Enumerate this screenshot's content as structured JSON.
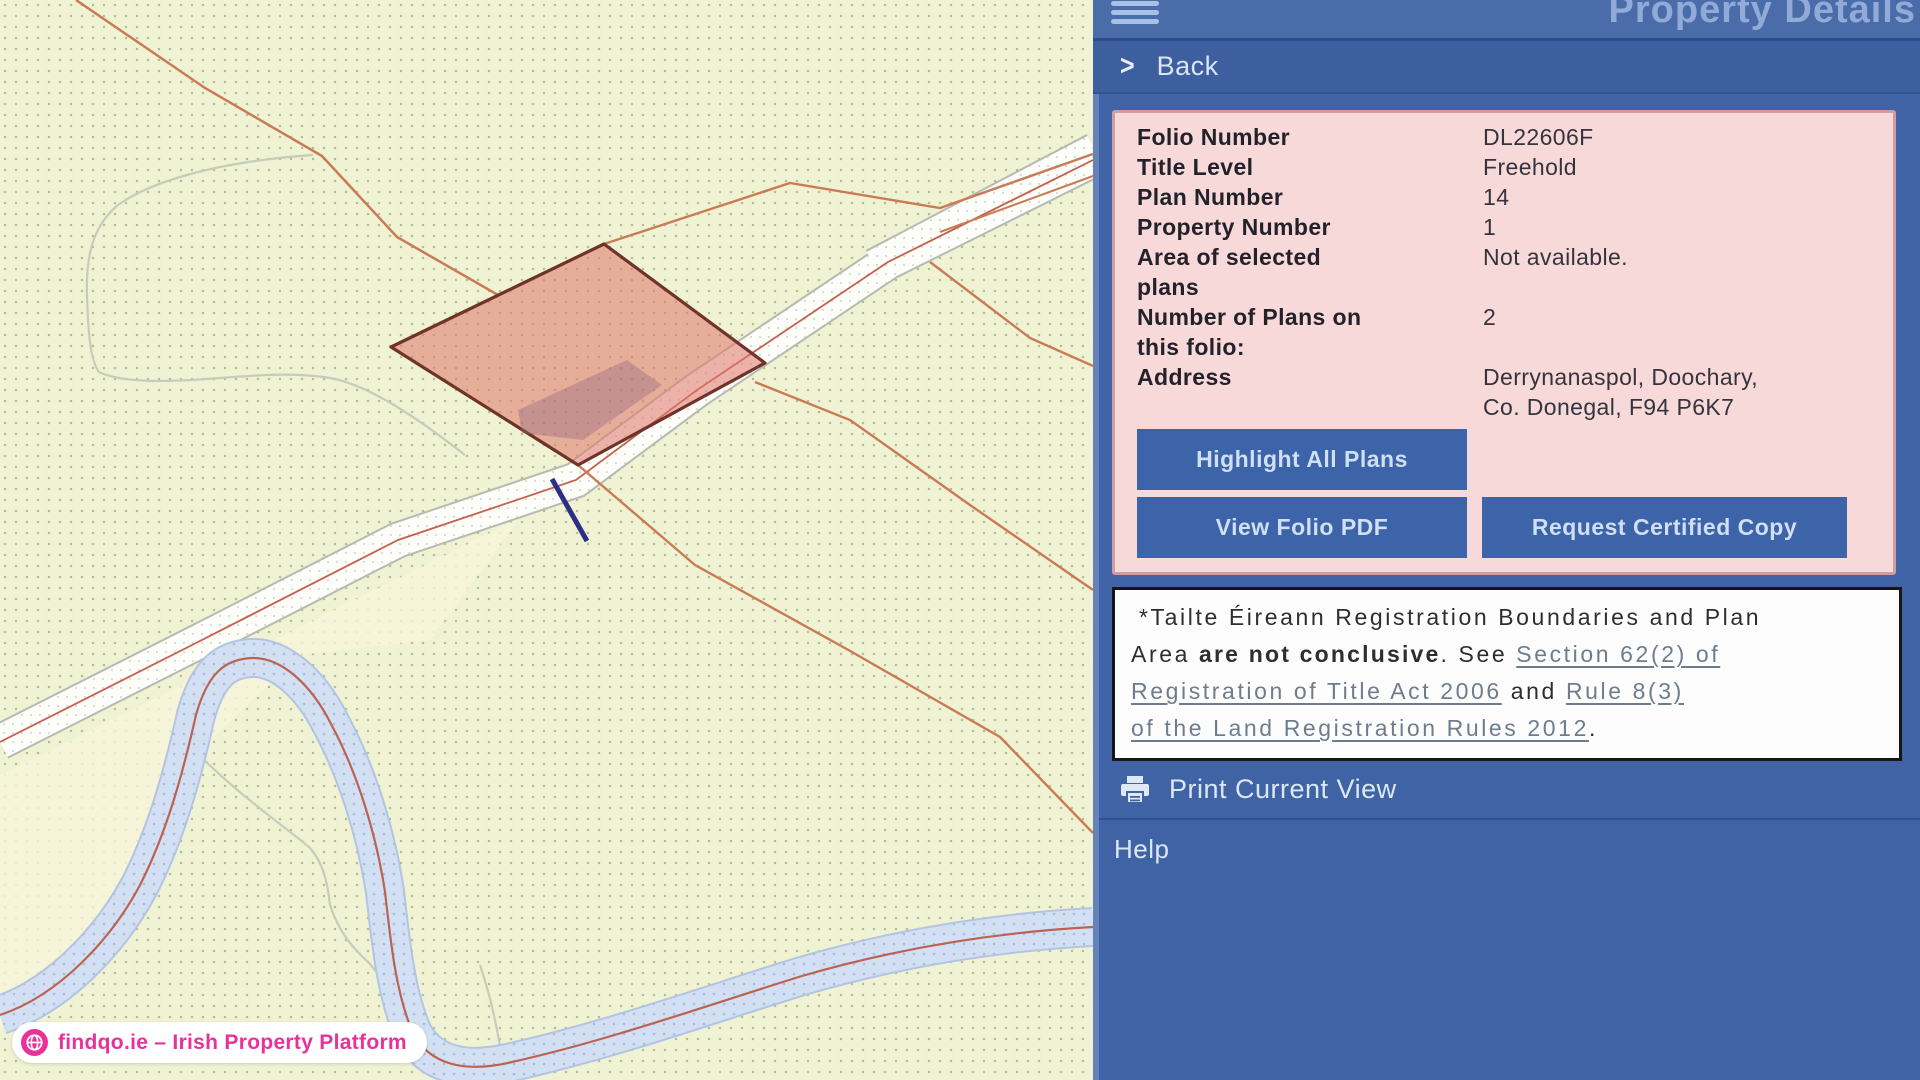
{
  "sidebar": {
    "title": "Property Details",
    "back_label": "Back",
    "details": {
      "rows": [
        {
          "label": "Folio Number",
          "value": "DL22606F"
        },
        {
          "label": "Title Level",
          "value": "Freehold"
        },
        {
          "label": "Plan Number",
          "value": "14"
        },
        {
          "label": "Property Number",
          "value": "1"
        },
        {
          "label": "Area of selected plans",
          "value": "Not available."
        },
        {
          "label": "Number of Plans on this folio:",
          "value": "2"
        },
        {
          "label": "Address",
          "value": "Derrynanaspol, Doochary, Co. Donegal, F94 P6K7"
        }
      ],
      "buttons": {
        "highlight": "Highlight All Plans",
        "view_pdf": "View Folio PDF",
        "request_copy": "Request Certified Copy"
      }
    },
    "disclaimer": {
      "segments": [
        {
          "t": "text",
          "v": "*Tailte Éireann Registration Boundaries and Plan"
        },
        {
          "t": "br"
        },
        {
          "t": "text",
          "v": "Area "
        },
        {
          "t": "bold",
          "v": "are not conclusive"
        },
        {
          "t": "text",
          "v": ". See "
        },
        {
          "t": "link",
          "v": "Section 62(2) of"
        },
        {
          "t": "br"
        },
        {
          "t": "link",
          "v": "Registration of Title Act 2006"
        },
        {
          "t": "text",
          "v": " and "
        },
        {
          "t": "link",
          "v": "Rule 8(3)"
        },
        {
          "t": "br"
        },
        {
          "t": "link",
          "v": "of the Land Registration Rules 2012"
        },
        {
          "t": "text",
          "v": "."
        }
      ]
    },
    "print_label": "Print Current View",
    "help_label": "Help"
  },
  "map": {
    "watermark": "findqo.ie – Irish Property Platform",
    "icons": [
      "hamburger-icon",
      "back-chevron-icon",
      "printer-icon",
      "globe-icon"
    ]
  },
  "colors": {
    "sidebar_blue": "#3f63a4",
    "header_blue": "#4a6da9",
    "back_row_blue": "#3e5f9f",
    "panel_pink": "#f8d9da",
    "panel_border": "#cf9da0",
    "button_blue": "#3d64a8",
    "parcel_fill": "#e07a6e",
    "parcel_border": "#6f332a",
    "boundary_orange": "#c97b55",
    "river_blue": "#d3e0f4",
    "road_white": "#fdfdf9",
    "map_bg": "#eff3d4",
    "brand_pink": "#e9319b",
    "disclaimer_link": "#6d7d8e"
  }
}
